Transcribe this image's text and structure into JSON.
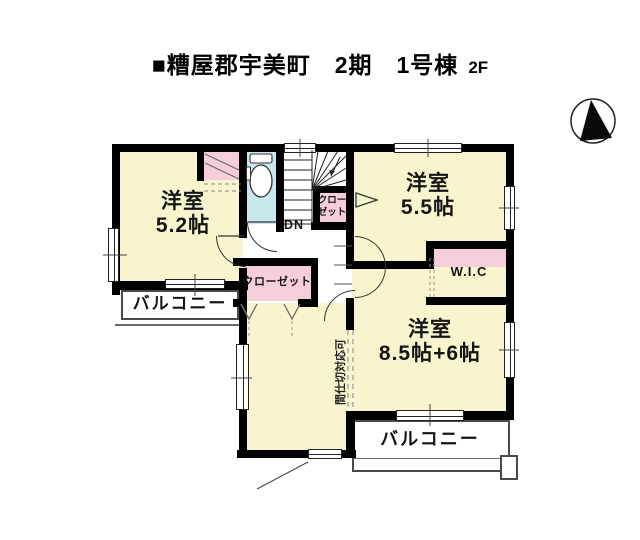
{
  "title": {
    "main": "■糟屋郡宇美町　2期　1号棟",
    "floor": "2F"
  },
  "rooms": {
    "room52": {
      "name": "洋室",
      "size": "5.2帖"
    },
    "room55": {
      "name": "洋室",
      "size": "5.5帖"
    },
    "room85": {
      "name": "洋室",
      "size": "8.5帖+6帖"
    },
    "wic": {
      "label": "W.I.C"
    },
    "closet_hall": {
      "label": "クローゼット"
    },
    "closet_stairs": {
      "line1": "クロー",
      "line2": "ゼット"
    },
    "balcony_left": {
      "label": "バルコニー"
    },
    "balcony_bottom": {
      "label": "バルコニー"
    },
    "stairs": {
      "down_label": "DN"
    },
    "partition_note": "間仕切対応可"
  },
  "colors": {
    "room": "#F8F5CE",
    "pink": "#F6CEDA",
    "toilet": "#C9E8EE",
    "wall": "#000000",
    "line": "#333333"
  }
}
